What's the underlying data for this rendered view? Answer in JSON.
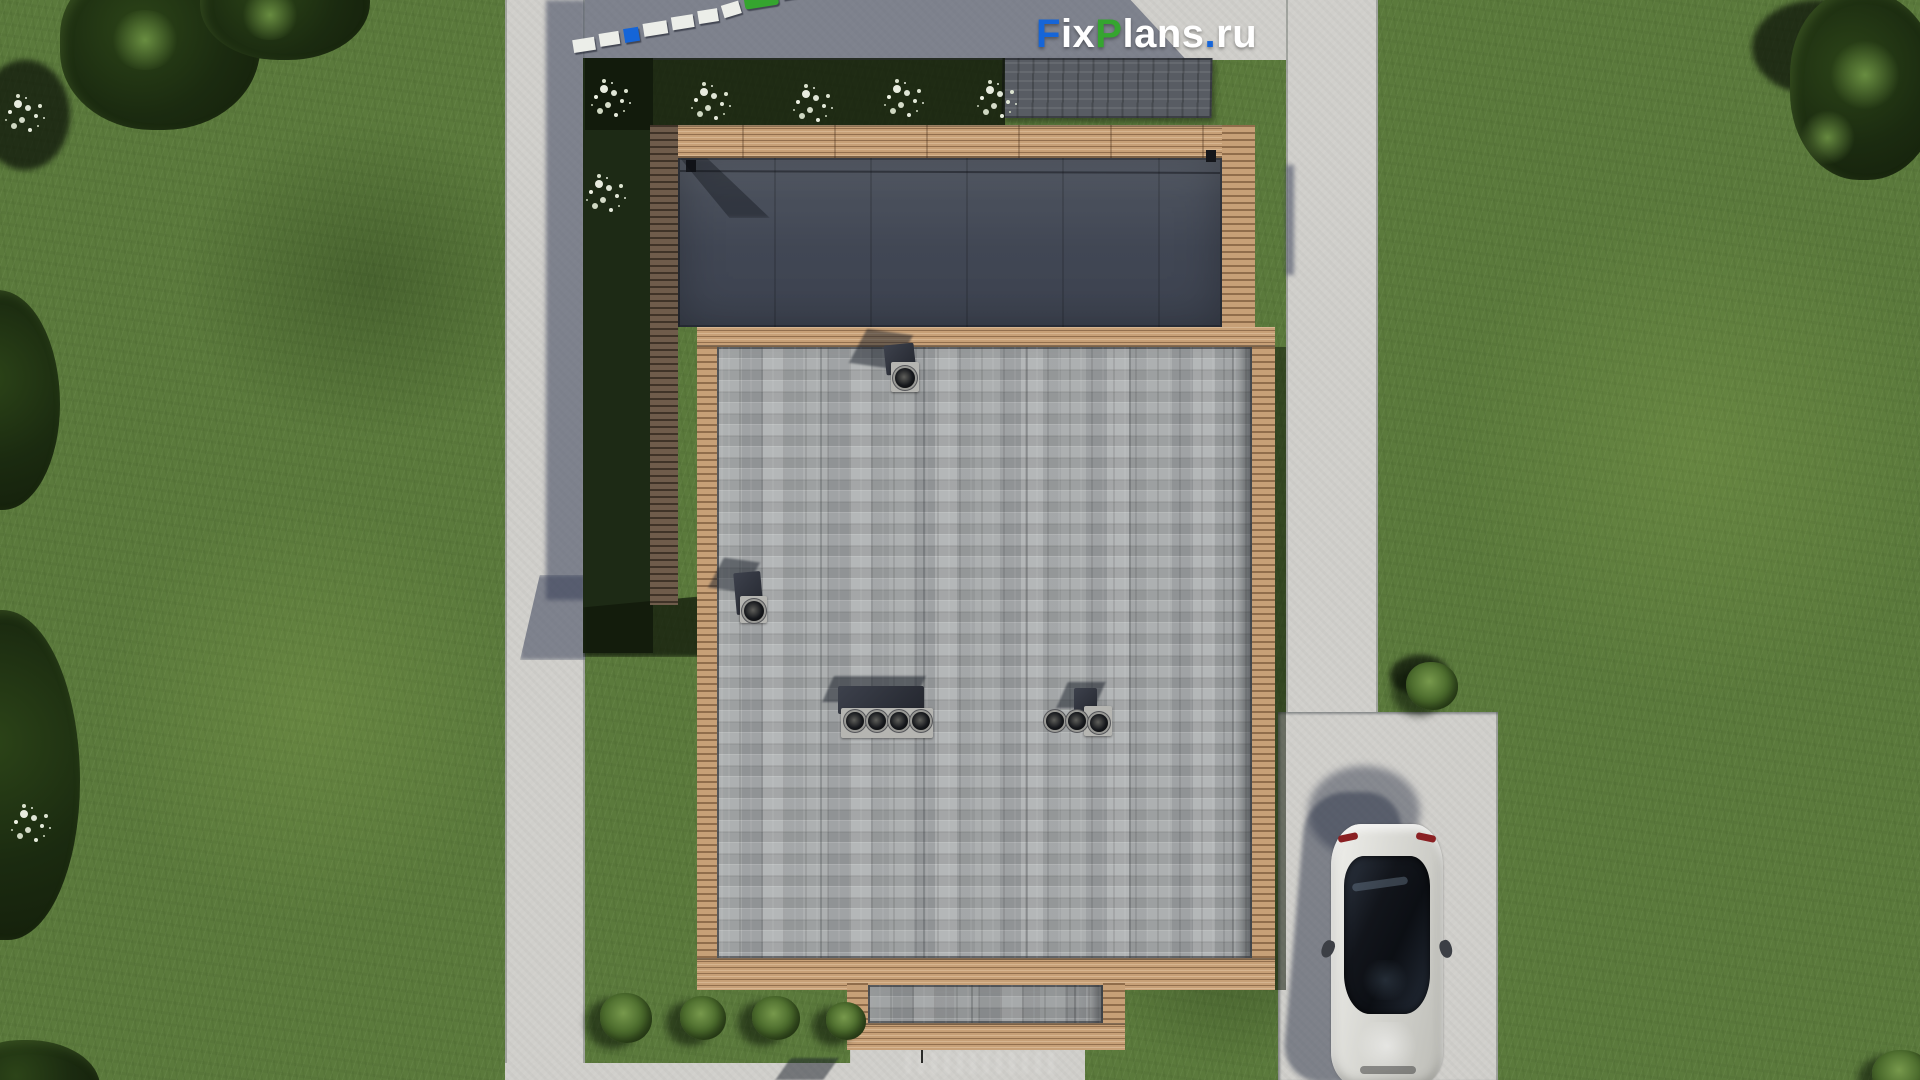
{
  "brand": {
    "logo_text": "FixPlans.ru",
    "parts": {
      "f": "F",
      "ix": "ix",
      "p": "P",
      "lans": "lans",
      "dot": ".",
      "ru": "ru"
    },
    "colors": {
      "blue": "#1565d8",
      "green": "#35a52f",
      "white": "#ffffff"
    }
  },
  "scene": {
    "description": "Top-down aerial 3D render of a modern flat-roof house plan on a lawn plot",
    "sun": "shadows cast toward upper-left",
    "ground": {
      "lawn_color": "#5b7a3c",
      "lawn_shadow_color": "#1d2a15",
      "concrete_color": "#d0cfcb"
    },
    "hardscape": {
      "left_walkway": "concrete walkway, west side, full height",
      "right_walkway": "concrete walkway, east side",
      "driveway": "concrete parking pad, south-east, with parked car",
      "entry_pad": "concrete entry pad, south",
      "rear_pad": "shaded concrete pad, north",
      "stone_mat": "dark stone mat, north-east"
    },
    "house": {
      "terrace": {
        "label": "pergola terrace with dark deck, north wing",
        "deck_color": "#434956",
        "trim_color": "#c7a077"
      },
      "main_roof": {
        "label": "gray shingle flat roof with wooden trim",
        "shingle_color": "#a5a8a9",
        "trim_color": "#c7a077"
      },
      "porch_roof": {
        "label": "small entry porch roof, south"
      },
      "roof_vents": {
        "single_stacks": 2,
        "group_of_four": 1,
        "group_of_three": 1
      }
    },
    "vehicle": {
      "label": "silver sedan parked nose-down on driveway",
      "body_color": "#d6d6d2",
      "glass_color": "#12151b"
    },
    "vegetation": {
      "white_flower_bushes": 8,
      "green_bushes": 6,
      "tree_groups": 2
    }
  }
}
